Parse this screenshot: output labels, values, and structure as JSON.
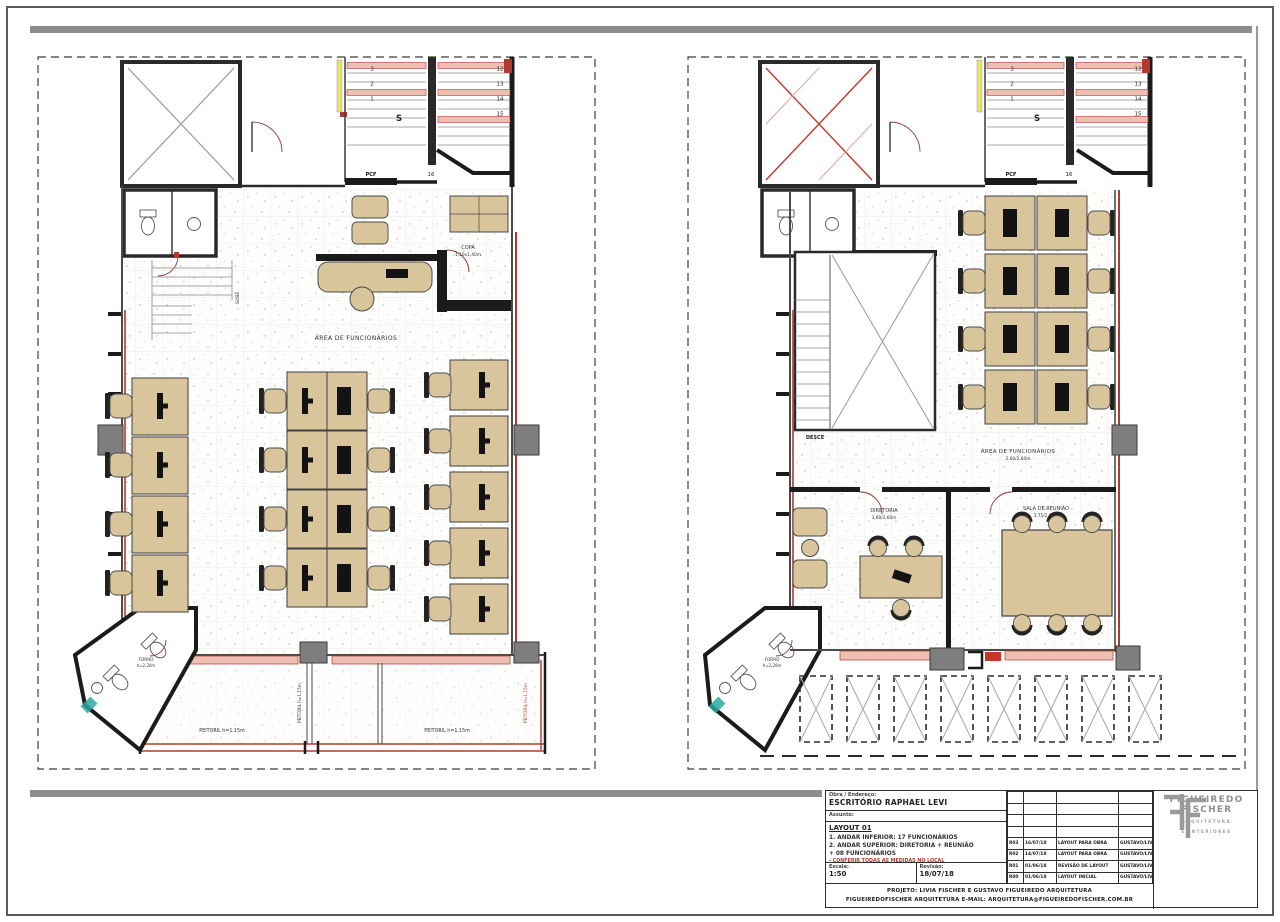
{
  "plans": {
    "left": {
      "area_label": "ÁREA DE FUNCIONÁRIOS",
      "copa_label": "COPA",
      "copa_dim": "1,10x1,40m",
      "sobe": "SOBE",
      "forro_label": "FORRO",
      "forro_dim": "h=2,20m",
      "peitoril_labels": [
        "PEITORIL h=1,15m",
        "PEITORIL h=1,15m",
        "PEITORIL h=1,15m",
        "PEITORIL h=1,15m"
      ],
      "stair": {
        "s": "S",
        "d": "D",
        "pcf": "PCF",
        "bottom_number": "16",
        "left_numbers": [
          "3",
          "2",
          "1"
        ],
        "right_numbers": [
          "12",
          "13",
          "14",
          "15"
        ]
      }
    },
    "right": {
      "area_label": "ÁREA DE FUNCIONÁRIOS",
      "area_dim": "2,60/2,60m",
      "diretoria_label": "DIRETORIA",
      "diretoria_dim": "3,60/2,60m",
      "reuniao_label": "SALA DE REUNIÃO",
      "reuniao_dim": "3,75/2,60m",
      "desce": "DESCE",
      "forro_label": "FORRO",
      "forro_dim": "h=2,20m",
      "stair": {
        "s": "S",
        "d": "D",
        "pcf": "PCF",
        "bottom_number": "16",
        "left_numbers": [
          "3",
          "2",
          "1"
        ],
        "right_numbers": [
          "12",
          "13",
          "14",
          "15"
        ]
      }
    }
  },
  "titleblock": {
    "obra_label": "Obra / Endereço:",
    "obra_value": "ESCRITÓRIO RAPHAEL LEVI",
    "assunto_label": "Assunto:",
    "layout_title": "LAYOUT 01",
    "line1": "1. ANDAR INFERIOR: 17 FUNCIONÁRIOS",
    "line2": "2. ANDAR SUPERIOR: DIRETORIA + REUNIÃO",
    "line3": "+ 08 FUNCIONÁRIOS",
    "warning": "- CONFERIR TODAS AS MEDIDAS NO LOCAL",
    "escala_label": "Escala:",
    "escala_value": "1:50",
    "revisao_label": "Revisão:",
    "revisao_value": "18/07/18",
    "revisions": [
      {
        "id": "R03",
        "date": "16/07/18",
        "desc": "LAYOUT PARA OBRA",
        "by": "GUSTAVO/LIVIA"
      },
      {
        "id": "R02",
        "date": "14/07/18",
        "desc": "LAYOUT PARA OBRA",
        "by": "GUSTAVO/LIVIA"
      },
      {
        "id": "R01",
        "date": "01/06/18",
        "desc": "REVISÃO DE LAYOUT",
        "by": "GUSTAVO/LIVIA"
      },
      {
        "id": "R00",
        "date": "01/06/18",
        "desc": "LAYOUT INICIAL",
        "by": "GUSTAVO/LIVIA"
      }
    ],
    "footer_line1": "PROJETO: LIVIA FISCHER E GUSTAVO FIGUEIREDO ARQUITETURA",
    "footer_line2": "FIGUEIREDOFISCHER ARQUITETURA  E-MAIL: ARQUITETURA@FIGUEIREDOFISCHER.COM.BR"
  },
  "logo": {
    "name_line1": "FIGUEIREDO",
    "name_line2": "FISCHER",
    "tagline_line1": "ARQUITETURA",
    "tagline_line2": "E INTERIORES"
  },
  "colors": {
    "accent_red": "#b03a30",
    "salmon": "#edbfb2",
    "desk_tan": "#d8c59c",
    "wall_black": "#1b1b1b",
    "column_gray": "#7e7e7e",
    "highlight_yellow": "#e9e36a",
    "teal": "#2aa7a0"
  }
}
